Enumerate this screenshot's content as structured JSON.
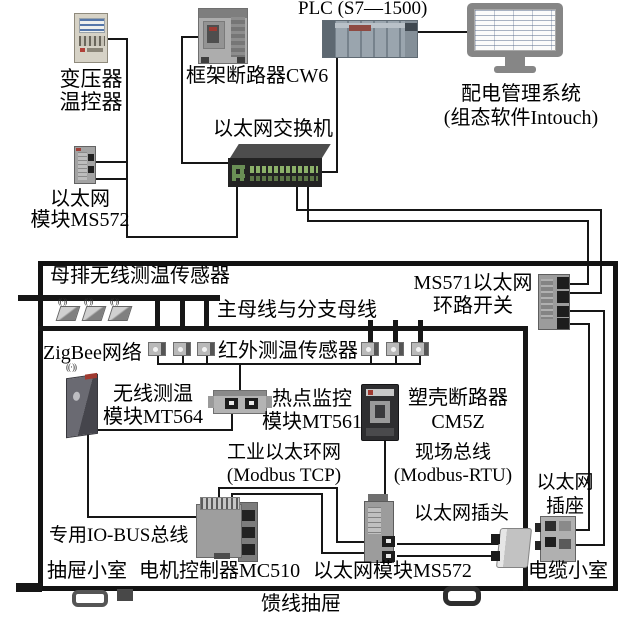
{
  "colors": {
    "wire": "#161616",
    "cabinet_border": "#121212",
    "switch_port_green": "#8cb169",
    "device_gray": "#9e9e9e",
    "breaker_dark": "#2e2e30"
  },
  "external": {
    "plc_label": "PLC (S7—1500)",
    "scada_label": "配电管理系统\n(组态软件Intouch)",
    "transformer_label": "变压器\n温控器",
    "breaker_cw6_label": "框架断路器CW6",
    "switch_label": "以太网交换机",
    "eth_module_label": "以太网\n模块MS572"
  },
  "cabinet": {
    "busbar_sensor_label": "母排无线测温传感器",
    "ms571_label": "MS571以太网\n环路开关",
    "bus_label": "主母线与分支母线",
    "zigbee_label": "ZigBee网络",
    "ir_sensor_label": "红外测温传感器",
    "mt564_label": "无线测温\n模块MT564",
    "mt561_label": "热点监控\n模块MT561",
    "cm5z_label": "塑壳断路器\nCM5Z",
    "ring_label": "工业以太环网\n(Modbus TCP)",
    "fieldbus_label": "现场总线\n(Modbus-RTU)",
    "plug_label": "以太网插头",
    "socket_label": "以太网\n插座",
    "iobus_label": "专用IO-BUS总线",
    "drawer_label": "抽屉小室",
    "mc510_label": "电机控制器MC510",
    "ms572_label": "以太网模块MS572",
    "cable_label": "电缆小室",
    "feeder_label": "馈线抽屉",
    "antenna_glyph": "((·))"
  }
}
